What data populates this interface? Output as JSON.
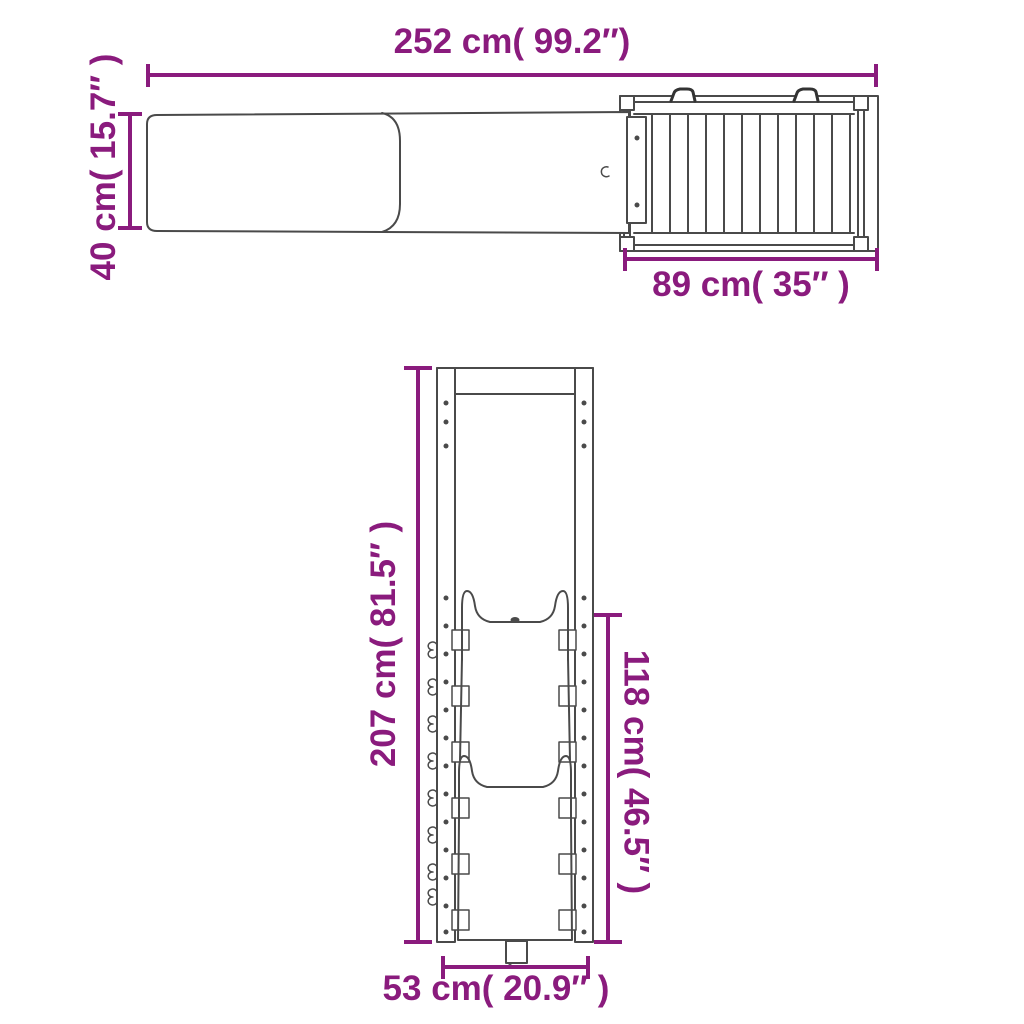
{
  "colors": {
    "accent": "#8a1b7d",
    "line": "#4a4a4a"
  },
  "views": {
    "top_view": {
      "title": "top-view-of-ramp-and-platform",
      "labels": {
        "overall_width": "252 cm( 99.2″)",
        "ramp_width": "40 cm( 15.7″ )",
        "platform_depth": "89 cm( 35″ )"
      }
    },
    "front_view": {
      "title": "front-view-of-slide-frame",
      "labels": {
        "overall_height": "207 cm( 81.5″ )",
        "slide_height": "118 cm( 46.5″ )",
        "base_width": "53 cm( 20.9″ )"
      }
    }
  }
}
